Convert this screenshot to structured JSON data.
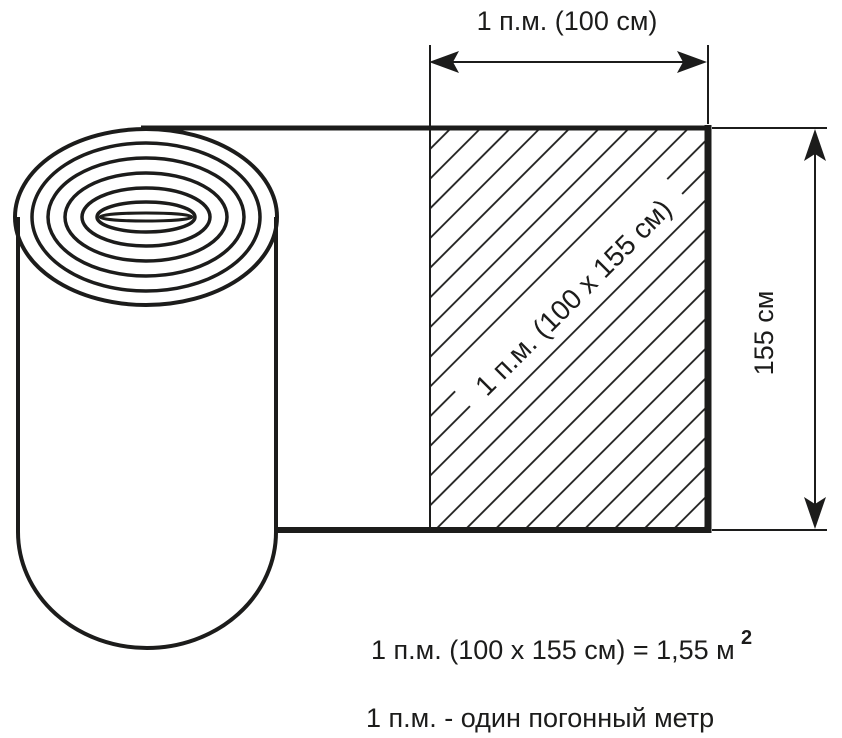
{
  "diagram": {
    "background_color": "#ffffff",
    "line_color": "#1c1c1b",
    "top_dimension": {
      "label": "1 п.м. (100 см)"
    },
    "side_dimension": {
      "label": "155 см"
    },
    "hatched_area": {
      "label": "1 п.м. (100 х 155 см)"
    },
    "formula": {
      "text": "1 п.м. (100 х 155 см) = 1,55 м",
      "exponent": "2"
    },
    "legend": {
      "text": "1 п.м. - один погонный метр"
    }
  }
}
